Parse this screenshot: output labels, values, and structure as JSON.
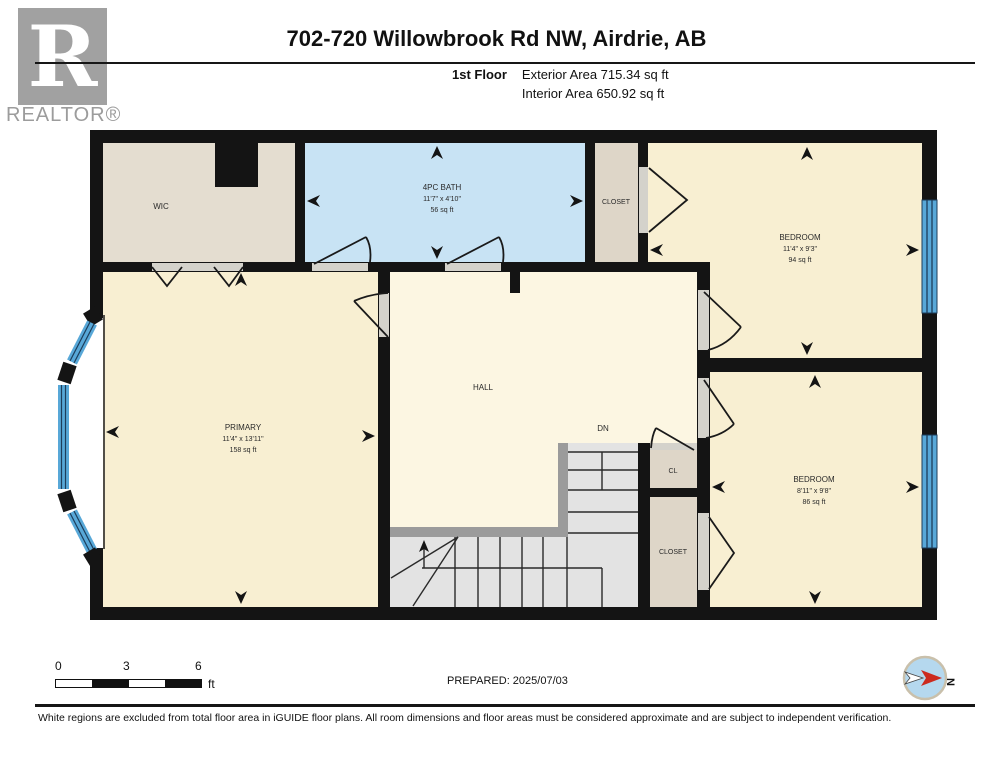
{
  "header": {
    "title": "702-720 Willowbrook Rd NW, Airdrie, AB",
    "floor_label": "1st Floor",
    "exterior_area": "Exterior Area 715.34 sq ft",
    "interior_area": "Interior Area 650.92 sq ft",
    "logo_letter": "R",
    "logo_text": "REALTOR®"
  },
  "rooms": {
    "wic": {
      "name": "WIC"
    },
    "bath": {
      "name": "4PC BATH",
      "dims": "11'7\" x 4'10\"",
      "area": "56 sq ft"
    },
    "closet_top": {
      "name": "CLOSET"
    },
    "bedroom_top": {
      "name": "BEDROOM",
      "dims": "11'4\" x 9'3\"",
      "area": "94 sq ft"
    },
    "primary": {
      "name": "PRIMARY",
      "dims": "11'4\" x 13'11\"",
      "area": "158 sq ft"
    },
    "hall": {
      "name": "HALL"
    },
    "stairs": {
      "direction": "DN"
    },
    "cl": {
      "name": "CL"
    },
    "closet_bottom": {
      "name": "CLOSET"
    },
    "bedroom_bottom": {
      "name": "BEDROOM",
      "dims": "8'11\" x 9'8\"",
      "area": "86 sq ft"
    }
  },
  "footer": {
    "scale_ticks": [
      "0",
      "3",
      "6"
    ],
    "scale_unit": "ft",
    "prepared": "PREPARED: 2025/07/03",
    "compass_label": "N",
    "disclaimer": "White regions are excluded from total floor area in iGUIDE floor plans. All room dimensions and floor areas must be considered approximate and are subject to independent verification."
  },
  "colors": {
    "wall": "#141414",
    "room_cream": "#f8efd2",
    "hall_cream": "#fcf6e2",
    "closet_beige": "#ded6c8",
    "wic_beige": "#e4ddd0",
    "bath_blue": "#c8e3f4",
    "window_blue": "#58a8d8",
    "stair_grey": "#e3e3e3",
    "railing_grey": "#9b9b9b",
    "compass_red": "#cc2a1e"
  }
}
